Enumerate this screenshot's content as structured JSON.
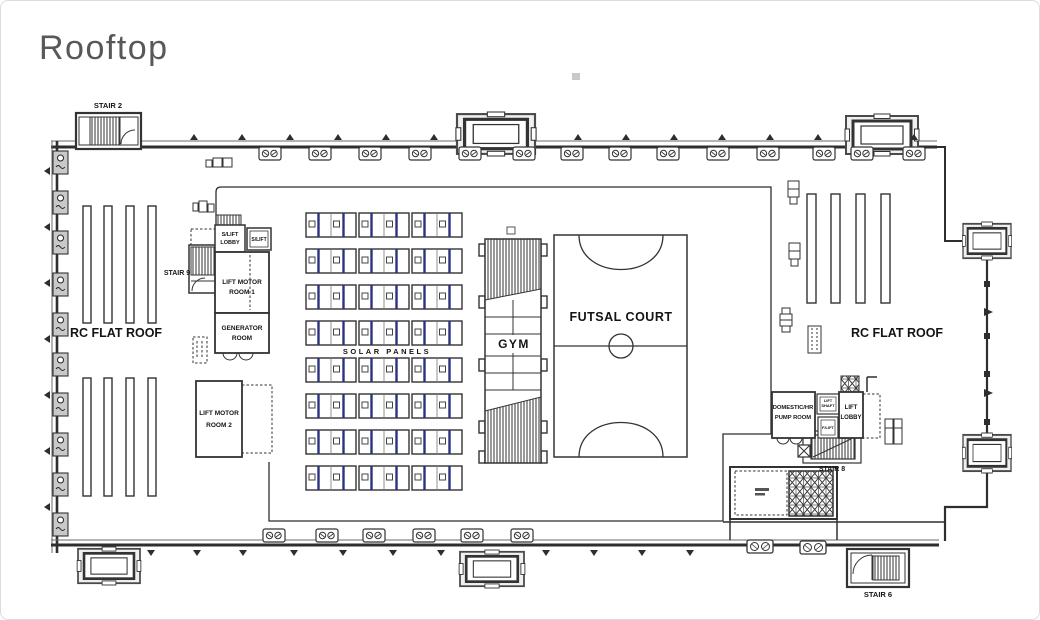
{
  "page": {
    "title": "Rooftop"
  },
  "colors": {
    "line": "#333333",
    "solar_panel_accent": "#2b3380",
    "title_text": "#58585a",
    "paper": "#ffffff"
  },
  "plan": {
    "stairs": {
      "stair2": "STAIR 2",
      "stair9": "STAIR 9",
      "stair8": "STAIR 8",
      "stair6": "STAIR 6"
    },
    "areas": {
      "rc_flat_roof_left": "RC FLAT ROOF",
      "rc_flat_roof_right": "RC FLAT ROOF",
      "solar_panels": "SOLAR PANELS",
      "gym": "GYM",
      "futsal_court": "FUTSAL COURT"
    },
    "rooms": {
      "slift_lobby": {
        "line1": "S/LIFT",
        "line2": "LOBBY"
      },
      "slift": "S/LIFT",
      "lift_motor_room_1": {
        "line1": "LIFT MOTOR",
        "line2": "ROOM 1"
      },
      "generator_room": {
        "line1": "GENERATOR",
        "line2": "ROOM"
      },
      "lift_motor_room_2": {
        "line1": "LIFT MOTOR",
        "line2": "ROOM 2"
      },
      "domestic_hr_pump_room": {
        "line1": "DOMESTIC/HR",
        "line2": "PUMP ROOM"
      },
      "lift_shaft": {
        "line1": "LIFT",
        "line2": "SHAFT"
      },
      "f_lift": "F/LIFT",
      "lift_lobby": {
        "line1": "LIFT",
        "line2": "LOBBY"
      }
    }
  }
}
